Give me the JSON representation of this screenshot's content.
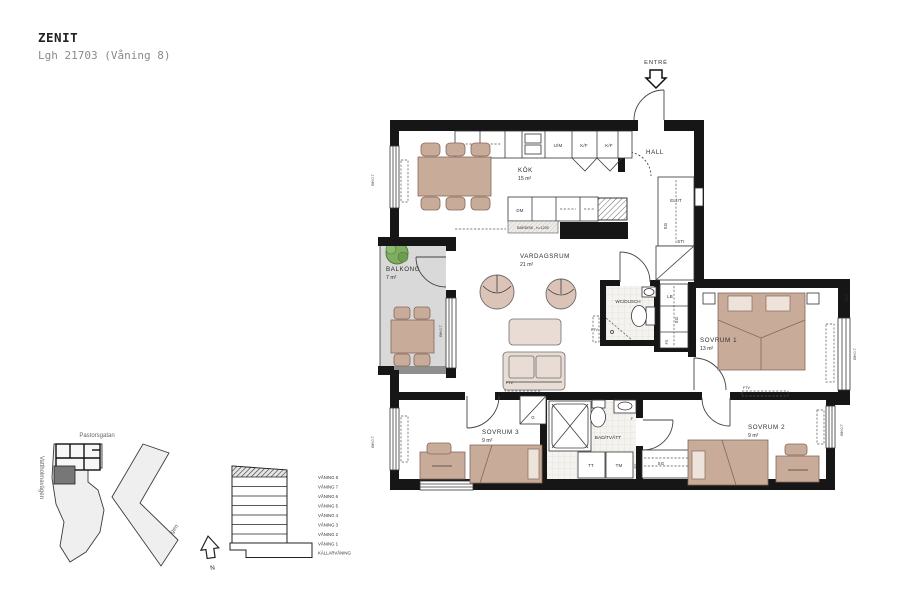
{
  "header": {
    "title": "ZENIT",
    "subtitle": "Lgh 21703 (Våning 8)"
  },
  "plan": {
    "entrance": {
      "label": "ENTRÉ"
    },
    "rooms": {
      "hall": {
        "name": "HALL"
      },
      "kok": {
        "name": "KÖK",
        "area": "15 m²"
      },
      "vardagsrum": {
        "name": "VARDAGSRUM",
        "area": "21 m²"
      },
      "balkong": {
        "name": "BALKONG",
        "area": "7 m²"
      },
      "wc": {
        "name": "WC/DUSCH"
      },
      "bad": {
        "name": "BAD/TVÄTT"
      },
      "sovrum1": {
        "name": "SOVRUM 1",
        "area": "13 m²"
      },
      "sovrum2": {
        "name": "SOVRUM 2",
        "area": "9 m²"
      },
      "sovrum3": {
        "name": "SOVRUM 3",
        "area": "9 m²"
      }
    },
    "appliances": {
      "um": "U/M",
      "kf1": "K/F",
      "kf2": "K/F",
      "dm": "DM",
      "bardisk": "BARDISK , h=1200",
      "tt": "TT",
      "tm": "TM"
    },
    "closets": {
      "elit": "EL/IT",
      "sg_hall": "SG",
      "sti": "STI",
      "lb": "LB",
      "sg_sov1": "SG",
      "fs_sov1": "FS",
      "g": "G",
      "f": "F",
      "sg_sov2": "SG",
      "fs_bad": "FS"
    },
    "annotations": {
      "bh_kok": "BH 0.7",
      "bh_balkong": "BH 0.7",
      "bh_sov3": "BH 0.7",
      "bh_sov1": "BH 0.7",
      "bh_sov2": "BH 0.7",
      "sro": "SRÖ",
      "ftv_wc": "FTV",
      "ftv_vardagsrum": "FTV",
      "ftv_sov2": "FTV"
    }
  },
  "site_plan": {
    "street_top": "Pastorsgatan",
    "street_left": "Vattholmavägen",
    "street_right": "Råbyvägen"
  },
  "building_section": {
    "floors": [
      "VÅNING 8",
      "VÅNING 7",
      "VÅNING 6",
      "VÅNING 5",
      "VÅNING 4",
      "VÅNING 3",
      "VÅNING 2",
      "VÅNING 1",
      "KÄLLARVÅNING"
    ],
    "highlighted_floor": "VÅNING 8"
  },
  "compass": {
    "north": "N"
  },
  "colors": {
    "wall": "#161616",
    "furniture": "#c9ab9a",
    "furniture_light": "#e9dcd4",
    "balcony_floor": "#d9d9d9",
    "site_building": "#efefef",
    "site_highlight": "#777777",
    "plant": "#7fae62"
  }
}
